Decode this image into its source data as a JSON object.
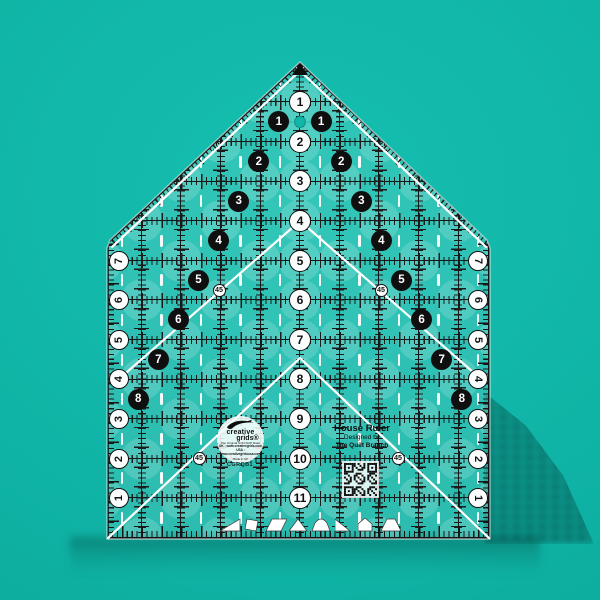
{
  "product": {
    "title": "House Ruler",
    "designed_by": "Designed by",
    "designer": "The Quilt Branch",
    "code": "CGRQB1"
  },
  "logo": {
    "brand_top": "creative",
    "brand_bottom": "grids®",
    "tagline": "The Original NON-SLIP Ruler",
    "line_uk": "UK : www.creativegrids.com",
    "line_usa": "USA : www.creativegridsusa.com",
    "made_in": "Made in UK"
  },
  "ruler": {
    "center_numbers": [
      1,
      2,
      3,
      4,
      5,
      6,
      7,
      8,
      9,
      10,
      11
    ],
    "left_edge_numbers": [
      7,
      6,
      5,
      4,
      3,
      2,
      1
    ],
    "right_edge_numbers": [
      7,
      6,
      5,
      4,
      3,
      2,
      1
    ],
    "diagonal_left_numbers": [
      1,
      2,
      3,
      4,
      5,
      6,
      7,
      8
    ],
    "diagonal_right_numbers": [
      1,
      2,
      3,
      4,
      5,
      6,
      7,
      8
    ],
    "angle_labels": [
      "45",
      "45",
      "45",
      "45"
    ]
  },
  "shapes_row": [
    "right-triangle",
    "tilted-square",
    "parallelogram",
    "triangle",
    "dome",
    "right-triangle-flip",
    "house",
    "trapezoid"
  ],
  "colors": {
    "background_teal": "#0fb3a5",
    "ruler_tint": "rgba(255,255,255,0.12)",
    "mark_black": "#161616",
    "mark_white": "#ffffff",
    "shadow": "rgba(2,64,58,0.35)"
  }
}
